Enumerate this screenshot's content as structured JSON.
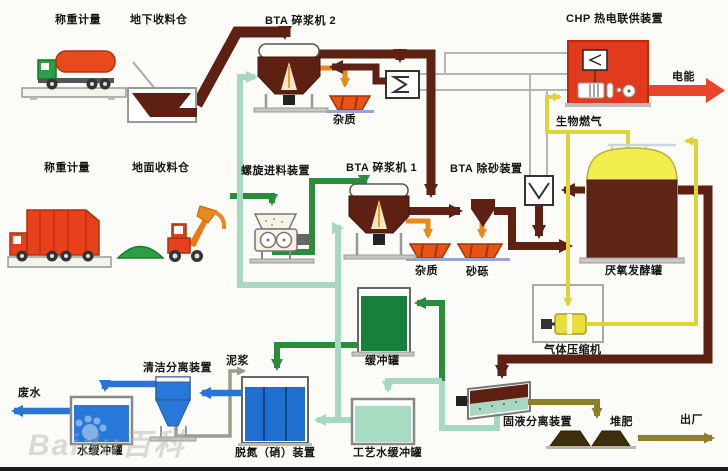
{
  "diagram_title": "BTA biogas plant process flow",
  "labels": {
    "weighing_top": "称重计量",
    "underground_bin": "地下收料仓",
    "pulper_2": "BTA 碎浆机 2",
    "chp_unit": "CHP 热电联供装置",
    "electric_power": "电能",
    "impurities_top": "杂质",
    "biogas": "生物燃气",
    "weighing_mid": "称重计量",
    "ground_bin": "地面收料仓",
    "screw_feeder": "螺旋进料装置",
    "pulper_1": "BTA 碎浆机 1",
    "grit_removal": "BTA 除砂装置",
    "digester": "厌氧发酵罐",
    "impurities_mid": "杂质",
    "grit": "砂砾",
    "gas_compressor": "气体压缩机",
    "buffer_tank": "缓冲罐",
    "slurry": "泥浆",
    "cleaning_separator": "清洁分离装置",
    "wastewater": "废水",
    "water_buffer_tank": "水缓冲罐",
    "denitrification": "脱氮（硝）装置",
    "process_water_tank": "工艺水缓冲罐",
    "solid_liquid_separator": "固液分离装置",
    "compost": "堆肥",
    "shipment": "出厂"
  },
  "watermark": "Baidu百科",
  "colors": {
    "substrate_line": "#5e2013",
    "process_water_line": "#a6d9c0",
    "recirculation_line": "#2c8c3c",
    "water_line": "#2a74d4",
    "biogas_line": "#ded437",
    "residue_line": "#e8891c",
    "heating_line": "#b8b8b8",
    "power_arrow": "#e8452b",
    "compost_line": "#8f7f2a",
    "digester_gas_dome": "#f2ee4e",
    "digester_body": "#5e2415"
  }
}
